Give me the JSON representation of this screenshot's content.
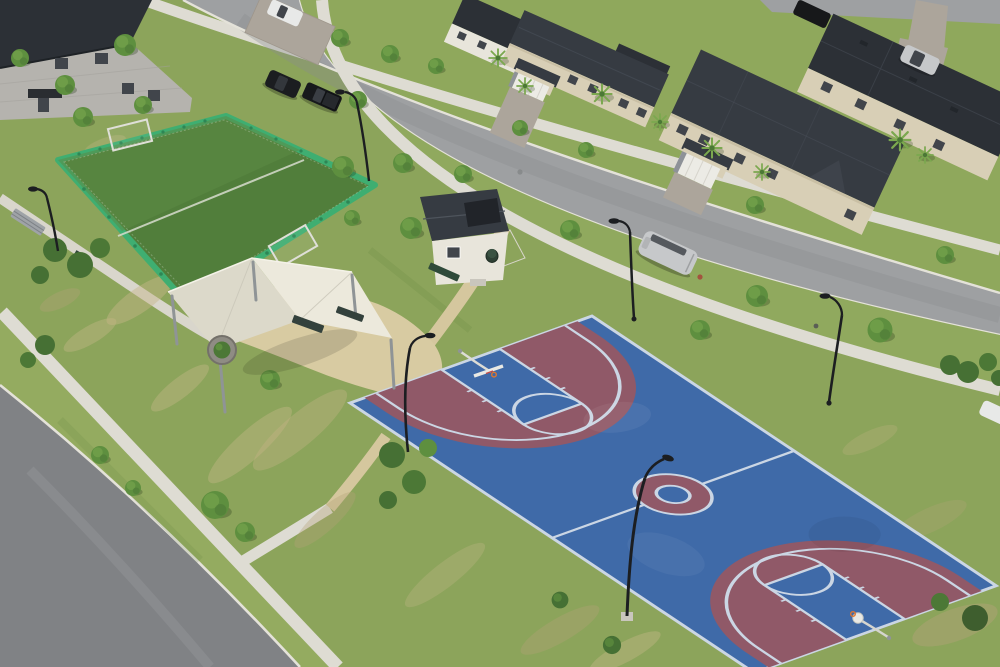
{
  "meta": {
    "type": "photograph",
    "view": "high oblique drone aerial",
    "description": "Aerial view of a residential community park with a fenced turf mini-soccer field, white shade-sail pavilion and a blue and maroon basketball court beside beige townhomes"
  },
  "palette": {
    "lawn": "#8CA45B",
    "lawn-band": "#90A95E",
    "park-band": "#94AB60",
    "far-lawn": "#8FA85C",
    "sand": "#C7B789",
    "dirt": "#B3A379",
    "field-green": "#7FAC4D",
    "field-sand": "#C8B37C",
    "asphalt": "#9EA0A2",
    "asphalt-dark": "#808285",
    "wear": "#8A8C8E",
    "curb": "#E4E2D9",
    "concrete": "#DEDCD3",
    "concrete-warm": "#D9D6CC",
    "pad-tan": "#D8CBA2",
    "path-tan": "#D5C79E",
    "turf": "#517E3B",
    "turf-light": "#5C8B45",
    "fence": "#3FAE71",
    "fence-dark": "#2E8655",
    "fence-rail": "#CFE8D8",
    "court-blue": "#3F6AA8",
    "court-maroon": "#905968",
    "court-line": "#CBD6E4",
    "rim-orange": "#E0762F",
    "hoop-white": "#E9E9E4",
    "roof-dark": "#2C3036",
    "roof-mid": "#363B42",
    "roof-edge": "#4A505A",
    "house-gray": "#B5B3AE",
    "beige": "#D8CFB6",
    "beige-dark": "#C9BFA4",
    "white-wall": "#E8E5DB",
    "garage-door": "#ECEBE5",
    "stone": "#8E9298",
    "paver": "#ACA59B",
    "glass": "#41454B",
    "tree-dark": "#4C7836",
    "tree-mid": "#5E8F3F",
    "tree-light": "#74A24C",
    "bush-green": "#467034",
    "palm-green": "#7BA84F",
    "canopy": "#ECE9DC",
    "canopy-shade": "#DCD9CA",
    "steel": "#8F9496",
    "light-pole": "#1C1E21",
    "car-black": "#1B1D20",
    "car-silver": "#C6C8CA",
    "car-white": "#E8E9E8",
    "bench-gray": "#9FA3A7",
    "bench-dark": "#33413C",
    "trash-green": "#2E4034",
    "base-concrete": "#C9C6BD"
  },
  "scene": {
    "park": {
      "soccer_field": {
        "surface": "green artificial turf",
        "enclosure": "green perimeter fence with mesh",
        "markings": [
          "white center line"
        ],
        "goals": 2
      },
      "basketball_court": {
        "surface": "blue acrylic with maroon three-point zones and keys",
        "markings": [
          "white boundary",
          "center circle",
          "free-throw lanes",
          "three-point arcs"
        ],
        "hoops": 2,
        "floodlights": 2
      },
      "shade_pavilion": {
        "canopy": "white sail shades",
        "posts": 5,
        "benches": 2,
        "planter": 1
      },
      "shed": {
        "walls": "white",
        "roof": "dark gray with panel"
      },
      "furniture": {
        "benches": 4,
        "trash_can": 1,
        "utility_box": 1
      },
      "paths": "concrete sidewalks and tan decomposed-granite walkways"
    },
    "streets": {
      "main_street": {
        "surface": "gray asphalt",
        "curbs": "white concrete gutters",
        "street_lights": 5
      },
      "side_street": {
        "location": "bottom left corner"
      },
      "rear_lane": {
        "location": "top right corner"
      }
    },
    "housing": {
      "gray_house": {
        "stories": 2,
        "walls": "gray concrete block",
        "roof": "charcoal"
      },
      "townhomes": {
        "walls": "beige stucco",
        "roofs": "charcoal shingle",
        "garage_doors": "white",
        "driveways": "gray pavers"
      }
    },
    "open_field": {
      "location": "top right",
      "features": [
        "green grass",
        "sand strip"
      ]
    },
    "vehicles": [
      {
        "type": "suv",
        "color": "black",
        "location": "main street"
      },
      {
        "type": "pickup",
        "color": "black",
        "location": "main street"
      },
      {
        "type": "minivan",
        "color": "silver",
        "location": "main street near curb"
      },
      {
        "type": "van",
        "color": "white",
        "location": "driveway top"
      },
      {
        "type": "suv",
        "color": "silver",
        "location": "rear lane"
      },
      {
        "type": "car",
        "color": "dark",
        "location": "rear lane"
      },
      {
        "type": "car",
        "color": "white",
        "location": "right edge"
      }
    ],
    "vegetation": {
      "young_trees": "evenly spaced along sidewalks",
      "palms": "in front of townhomes",
      "bushes": "along paths and court corner"
    }
  }
}
